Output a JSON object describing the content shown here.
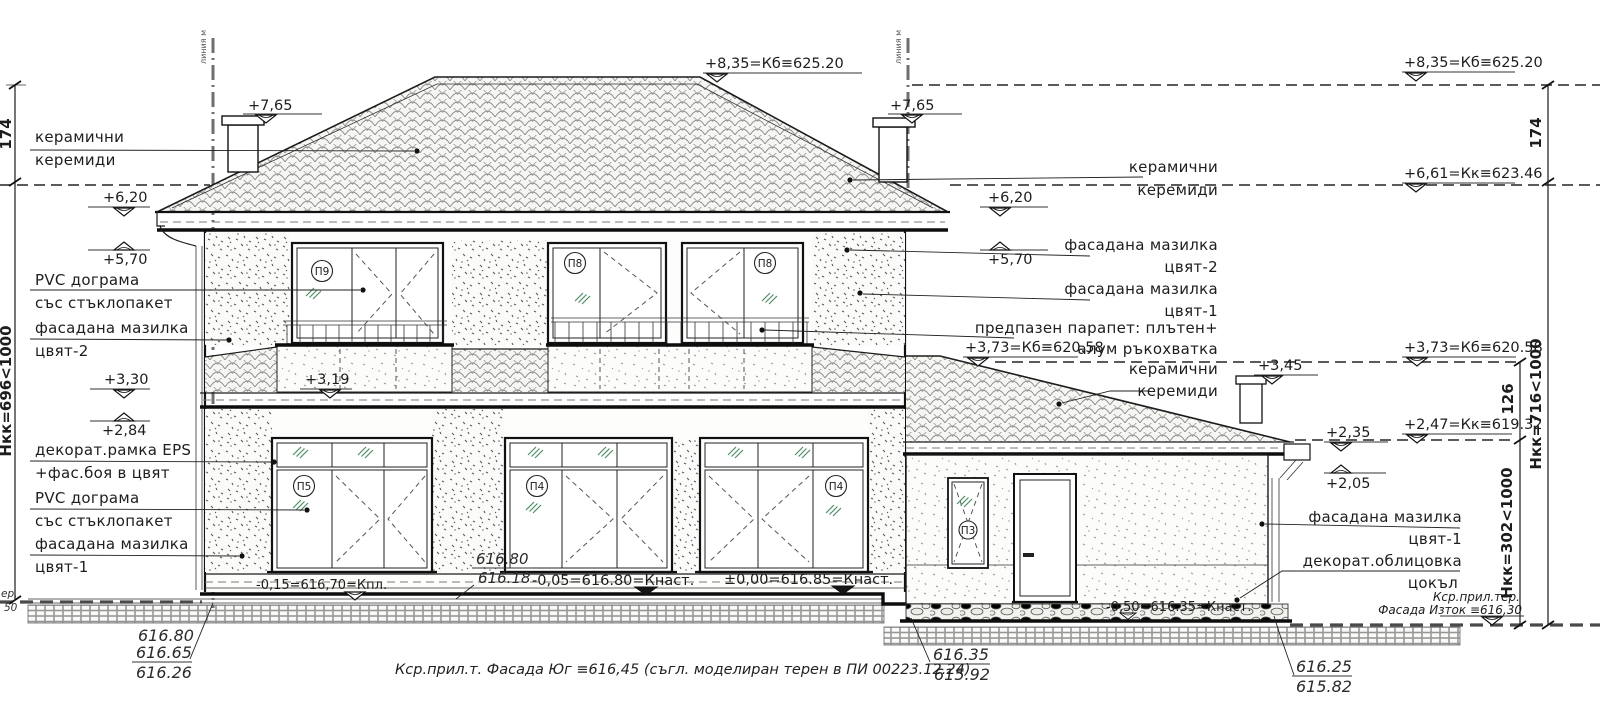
{
  "meta": {
    "colors": {
      "red": "#b3342b",
      "glass_green": "#4e8f66"
    }
  },
  "notes": {
    "bottom": "Кср.прил.т. Фасада Юг ≡616,45 (съгл. моделиран терен в ПИ 00223.12.24)",
    "east_1": "Кср.прил.тер.",
    "east_2": "Фасада Изток ≡616,30",
    "west_1": "ер.",
    "west_2": "50",
    "reg_line": "линия м"
  },
  "left_labels": [
    {
      "a": "керамични",
      "b": "керемиди"
    },
    {
      "a": "PVC дограма",
      "b": "със стъклопакет"
    },
    {
      "a": "фасадана мазилка",
      "b": "цвят-2"
    },
    {
      "a": "декорат.рамка EPS",
      "b": "+фас.боя в цвят"
    },
    {
      "a": "PVC дограма",
      "b": "със стъклопакет"
    },
    {
      "a": "фасадана мазилка",
      "b": "цвят-1"
    }
  ],
  "right_labels": [
    {
      "a": "керамични",
      "b": "керемиди"
    },
    {
      "a": "фасадана мазилка",
      "b": "цвят-2"
    },
    {
      "a": "фасадана мазилка",
      "b": "цвят-1"
    },
    {
      "a": "предпазен парапет: плътен+",
      "b": "алум ръкохватка"
    },
    {
      "a": "керамични",
      "b": "керемиди"
    },
    {
      "a": "фасадана мазилка",
      "b": "цвят-1"
    },
    {
      "a": "декорат.облицовка",
      "b": "цокъл"
    }
  ],
  "levels": {
    "p835c": "+8,35=Кб≡625.20",
    "p835r": "+8,35=Кб≡625.20",
    "p765l": "+7,65",
    "p765r": "+7,65",
    "p661": "+6,61=Кк≡623.46",
    "p620l": "+6,20",
    "p620r": "+6,20",
    "p570l": "+5,70",
    "p570r": "+5,70",
    "p373m": "+3,73=Кб≡620.58",
    "p373r": "+3,73=Кб≡620.58",
    "p345": "+3,45",
    "p330": "+3,30",
    "p319": "+3,19",
    "p284": "+2,84",
    "p247": "+2,47=Кк≡619.32",
    "p235": "+2,35",
    "p205": "+2,05",
    "m015": "-0,15=616,70=Кпл.",
    "m005": "-0,05=616.80=Кнаст.",
    "z000": "±0,00=616.85=Кнаст.",
    "m050": "-0,50=616.35=Кнаст."
  },
  "dims": {
    "d174l": "174",
    "d174r": "174",
    "d126": "126",
    "hkk_main": "Нкк=696<1000",
    "hkk_right": "Нкк=716<1000",
    "hkk_annex": "Нкк=302<1000"
  },
  "ground": {
    "left_red1": "616.80",
    "left_red2": "616.65",
    "left_black": "616.26",
    "center_red": "616.80",
    "center_black": "616.18",
    "mid_red": "616.35",
    "mid_black": "615.92",
    "right_red": "616.25",
    "right_black": "615.82"
  },
  "tags": {
    "p9": "П9",
    "p8a": "П8",
    "p8b": "П8",
    "p5": "П5",
    "p4a": "П4",
    "p4b": "П4",
    "p3": "П3"
  }
}
